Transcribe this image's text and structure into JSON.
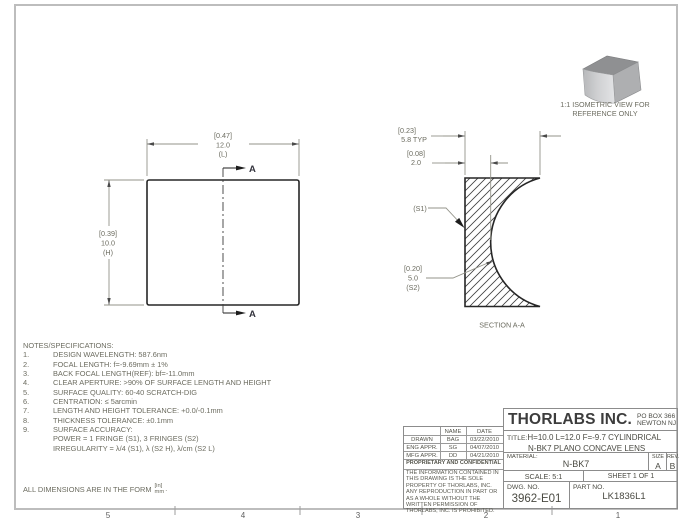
{
  "sheet": {
    "zones": [
      "5",
      "4",
      "3",
      "2",
      "1"
    ],
    "form_label": "ALL DIMENSIONS ARE IN THE FORM",
    "form_numerator": "[in]",
    "form_denominator": "mm",
    "form_period": "."
  },
  "notes": {
    "header": "NOTES/SPECIFICATIONS:",
    "items": [
      {
        "num": "1.",
        "text": "DESIGN WAVELENGTH: 587.6nm"
      },
      {
        "num": "2.",
        "text": "FOCAL LENGTH: f=-9.69mm ± 1%"
      },
      {
        "num": "3.",
        "text": "BACK FOCAL LENGTH(REF): bf=-11.0mm"
      },
      {
        "num": "4.",
        "text": "CLEAR APERTURE: >90% OF SURFACE LENGTH AND HEIGHT"
      },
      {
        "num": "5.",
        "text": "SURFACE QUALITY: 60-40 SCRATCH-DIG"
      },
      {
        "num": "6.",
        "text": "CENTRATION: ≤ 5arcmin"
      },
      {
        "num": "7.",
        "text": "LENGTH AND HEIGHT TOLERANCE: +0.0/-0.1mm"
      },
      {
        "num": "8.",
        "text": "THICKNESS TOLERANCE: ±0.1mm"
      },
      {
        "num": "9.",
        "text": "SURFACE ACCURACY:"
      },
      {
        "num": "",
        "text": "POWER = 1 FRINGE (S1), 3 FRINGES (S2)"
      },
      {
        "num": "",
        "text": "IRREGULARITY = λ/4 (S1), λ (S2 H), λ/cm (S2 L)"
      }
    ]
  },
  "front_view": {
    "width_dim": {
      "in": "[0.47]",
      "mm": "12.0",
      "axis": "(L)"
    },
    "height_dim": {
      "in": "[0.39]",
      "mm": "10.0",
      "axis": "(H)"
    },
    "section_letter": "A"
  },
  "section_view": {
    "edge_dim": {
      "in": "[0.23]",
      "mm": "5.8  TYP"
    },
    "center_dim": {
      "in": "[0.08]",
      "mm": "2.0"
    },
    "s1_label": "(S1)",
    "radius_dim": {
      "in": "[0.20]",
      "mm": "5.0",
      "surf": "(S2)"
    },
    "caption": "SECTION A-A"
  },
  "isometric": {
    "caption_line1": "1:1 ISOMETRIC VIEW FOR",
    "caption_line2": "REFERENCE ONLY"
  },
  "title_block": {
    "company": "THORLABS INC.",
    "address_line1": "PO BOX 366",
    "address_line2": "NEWTON NJ",
    "title_label": "TITLE:",
    "title_line1": "H=10.0 L=12.0 F=-9.7 CYLINDRICAL",
    "title_line2": "N-BK7 PLANO CONCAVE LENS",
    "material_label": "MATERIAL:",
    "material_value": "N-BK7",
    "size_label": "SIZE",
    "size_value": "A",
    "rev_label": "REV.",
    "rev_value": "B",
    "scale": "SCALE: 5:1",
    "sheet": "SHEET 1 OF 1",
    "dwg_label": "DWG.  NO.",
    "dwg_value": "3962-E01",
    "part_label": "PART  NO.",
    "part_value": "LK1836L1"
  },
  "approvals": {
    "name_header": "NAME",
    "date_header": "DATE",
    "rows": [
      {
        "role": "DRAWN",
        "name": "BAG",
        "date": "03/22/2010"
      },
      {
        "role": "ENG APPR.",
        "name": "SG",
        "date": "04/07/2010"
      },
      {
        "role": "MFG APPR.",
        "name": "DD",
        "date": "04/21/2010"
      }
    ],
    "prop_header": "PROPRIETARY AND CONFIDENTIAL",
    "prop_text": "THE INFORMATION CONTAINED IN THIS DRAWING IS THE SOLE PROPERTY OF THORLABS, INC.  ANY REPRODUCTION IN PART OR AS A WHOLE WITHOUT THE WRITTEN PERMISSION OF THORLABS, INC. IS PROHIBITED."
  }
}
